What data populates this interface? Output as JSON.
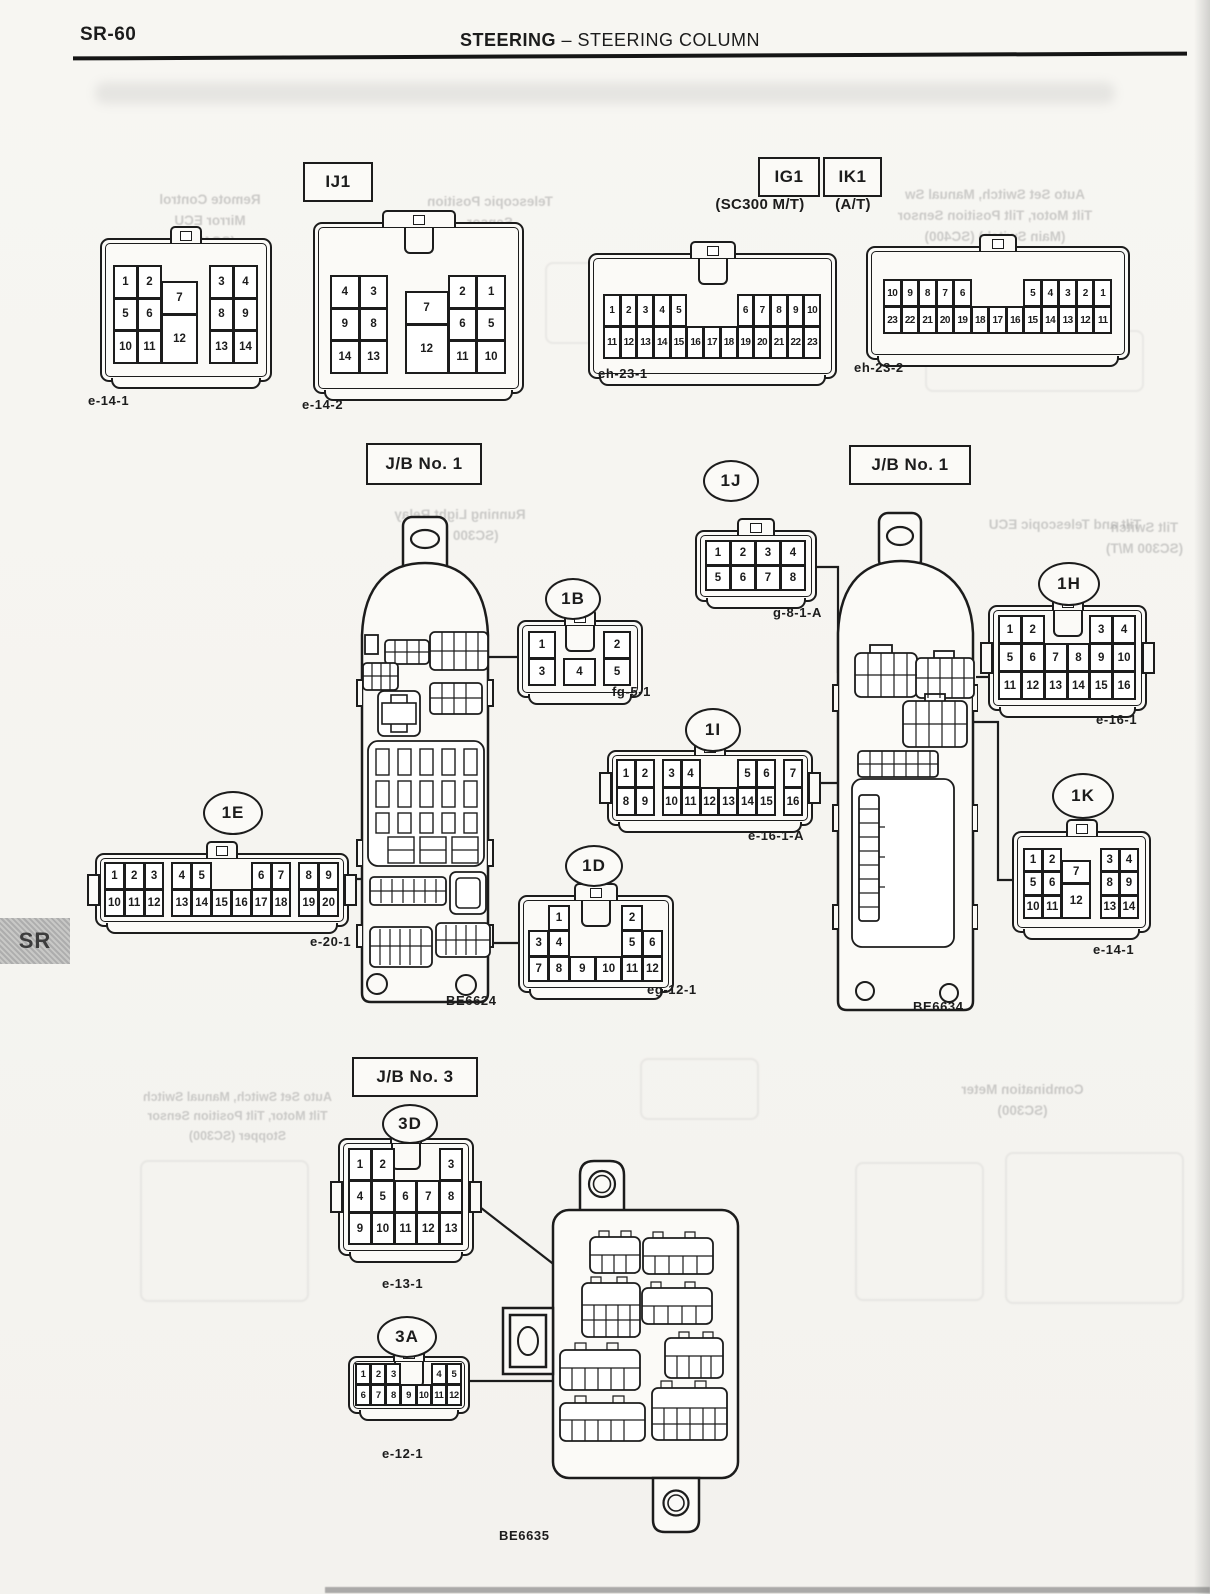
{
  "header": {
    "page_code": "SR-60",
    "section_main": "STEERING",
    "section_rest": " – STEERING COLUMN",
    "side_tab": "SR"
  },
  "boxes": {
    "ij1": "IJ1",
    "ig1": "IG1",
    "ik1": "IK1",
    "jb1_left": "J/B No. 1",
    "jb1_right": "J/B No. 1",
    "jb3": "J/B No. 3"
  },
  "subs": {
    "sc300mt": "(SC300 M/T)",
    "at": "(A/T)"
  },
  "bubbles": {
    "b1B": "1B",
    "b1J": "1J",
    "b1H": "1H",
    "b1I": "1I",
    "b1E": "1E",
    "b1D": "1D",
    "b1K": "1K",
    "b3D": "3D",
    "b3A": "3A"
  },
  "codes": {
    "e14_1": "e-14-1",
    "e14_2": "e-14-2",
    "eh23_1": "eh-23-1",
    "eh23_2": "eh-23-2",
    "fg5_1": "fg-5-1",
    "g8_1A": "g-8-1-A",
    "e16_1": "e-16-1",
    "e16_1A": "e-16-1-A",
    "e20_1": "e-20-1",
    "eg12_1": "eg-12-1",
    "e14_1k": "e-14-1",
    "e13_1": "e-13-1",
    "e12_1": "e-12-1",
    "be6624": "BE6624",
    "be6634": "BE6634",
    "be6635": "BE6635"
  },
  "connectors": {
    "e14_1": {
      "cols": "10,10,15,5,10,10",
      "rows": 6,
      "pad": "26px 12px 16px 12px",
      "cells": [
        [
          "1",
          1,
          1,
          1,
          2
        ],
        [
          "2",
          2,
          1,
          1,
          2
        ],
        [
          "5",
          1,
          3,
          1,
          2
        ],
        [
          "6",
          2,
          3,
          1,
          2
        ],
        [
          "10",
          1,
          5,
          1,
          2
        ],
        [
          "11",
          2,
          5,
          1,
          2
        ],
        [
          "7",
          3,
          2,
          1,
          2
        ],
        [
          "12",
          3,
          4,
          1,
          3
        ],
        [
          "3",
          5,
          1,
          1,
          2
        ],
        [
          "4",
          6,
          1,
          1,
          2
        ],
        [
          "8",
          5,
          3,
          1,
          2
        ],
        [
          "9",
          6,
          3,
          1,
          2
        ],
        [
          "13",
          5,
          5,
          1,
          2
        ],
        [
          "14",
          6,
          5,
          1,
          2
        ]
      ]
    },
    "e14_2": {
      "cols": "10,10,6,15,10,10",
      "rows": 6,
      "pad": "52px 16px 18px 16px",
      "lw": 70,
      "key": true,
      "cells": [
        [
          "4",
          1,
          1,
          1,
          2
        ],
        [
          "3",
          2,
          1,
          1,
          2
        ],
        [
          "9",
          1,
          3,
          1,
          2
        ],
        [
          "8",
          2,
          3,
          1,
          2
        ],
        [
          "14",
          1,
          5,
          1,
          2
        ],
        [
          "13",
          2,
          5,
          1,
          2
        ],
        [
          "7",
          4,
          2,
          1,
          2
        ],
        [
          "12",
          4,
          4,
          1,
          3
        ],
        [
          "2",
          5,
          1,
          1,
          2
        ],
        [
          "1",
          6,
          1,
          1,
          2
        ],
        [
          "6",
          5,
          3,
          1,
          2
        ],
        [
          "5",
          6,
          3,
          1,
          2
        ],
        [
          "11",
          5,
          5,
          1,
          2
        ],
        [
          "10",
          6,
          5,
          1,
          2
        ]
      ]
    },
    "eh23_1": {
      "cols": "1,1,1,1,1,1,1,1,1,1,1,1,1,1,1,1,1,1,1,1,1,1,1,1,1,1",
      "rows": 2,
      "pad": "40px 14px 18px 14px",
      "lw": 42,
      "key": true,
      "cells": [
        [
          "1",
          1,
          1,
          2
        ],
        [
          "2",
          3,
          1,
          2
        ],
        [
          "3",
          5,
          1,
          2
        ],
        [
          "4",
          7,
          1,
          2
        ],
        [
          "5",
          9,
          1,
          2
        ],
        [
          "6",
          17,
          1,
          2
        ],
        [
          "7",
          19,
          1,
          2
        ],
        [
          "8",
          21,
          1,
          2
        ],
        [
          "9",
          23,
          1,
          2
        ],
        [
          "10",
          25,
          1,
          2
        ],
        [
          "11",
          1,
          2,
          2
        ],
        [
          "12",
          3,
          2,
          2
        ],
        [
          "13",
          5,
          2,
          2
        ],
        [
          "14",
          7,
          2,
          2
        ],
        [
          "15",
          9,
          2,
          2
        ],
        [
          "16",
          11,
          2,
          2
        ],
        [
          "17",
          13,
          2,
          2
        ],
        [
          "18",
          15,
          2,
          2
        ],
        [
          "19",
          17,
          2,
          2
        ],
        [
          "20",
          19,
          2,
          2
        ],
        [
          "21",
          21,
          2,
          2
        ],
        [
          "22",
          23,
          2,
          2
        ],
        [
          "23",
          25,
          2,
          2
        ]
      ]
    },
    "eh23_2": {
      "cols": "1,1,1,1,1,1,1,1,1,1,1,1,1,1,1,1,1,1,1,1,1,1,1,1,1,1",
      "rows": 2,
      "pad": "32px 16px 24px 16px",
      "lw": 34,
      "cells": [
        [
          "10",
          1,
          1,
          2
        ],
        [
          "9",
          3,
          1,
          2
        ],
        [
          "8",
          5,
          1,
          2
        ],
        [
          "7",
          7,
          1,
          2
        ],
        [
          "6",
          9,
          1,
          2
        ],
        [
          "5",
          17,
          1,
          2
        ],
        [
          "4",
          19,
          1,
          2
        ],
        [
          "3",
          21,
          1,
          2
        ],
        [
          "2",
          23,
          1,
          2
        ],
        [
          "1",
          25,
          1,
          2
        ],
        [
          "23",
          1,
          2,
          2
        ],
        [
          "22",
          3,
          2,
          2
        ],
        [
          "21",
          5,
          2,
          2
        ],
        [
          "20",
          7,
          2,
          2
        ],
        [
          "19",
          9,
          2,
          2
        ],
        [
          "18",
          11,
          2,
          2
        ],
        [
          "17",
          13,
          2,
          2
        ],
        [
          "16",
          15,
          2,
          2
        ],
        [
          "15",
          17,
          2,
          2
        ],
        [
          "14",
          19,
          2,
          2
        ],
        [
          "13",
          21,
          2,
          2
        ],
        [
          "12",
          23,
          2,
          2
        ],
        [
          "11",
          25,
          2,
          2
        ]
      ]
    },
    "fg5_1": {
      "cols": "10,3,12,3,10",
      "rows": 2,
      "pad": "10px",
      "key": true,
      "cells": [
        [
          "1",
          1,
          1
        ],
        [
          "2",
          5,
          1
        ],
        [
          "3",
          1,
          2
        ],
        [
          "4",
          3,
          2
        ],
        [
          "5",
          5,
          2
        ]
      ]
    },
    "g8_1A": {
      "cols": "1,1,1,1",
      "rows": 2,
      "pad": "9px",
      "lw": 34,
      "cells": [
        [
          "1",
          1,
          1
        ],
        [
          "2",
          2,
          1
        ],
        [
          "3",
          3,
          1
        ],
        [
          "4",
          4,
          1
        ],
        [
          "5",
          1,
          2
        ],
        [
          "6",
          2,
          2
        ],
        [
          "7",
          3,
          2
        ],
        [
          "8",
          4,
          2
        ]
      ]
    },
    "e16_1": {
      "cols": "1,1,1,1,1,1",
      "rows": 3,
      "pad": "9px",
      "ears": true,
      "key": true,
      "cells": [
        [
          "1",
          1,
          1
        ],
        [
          "2",
          2,
          1
        ],
        [
          "3",
          5,
          1
        ],
        [
          "4",
          6,
          1
        ],
        [
          "5",
          1,
          2
        ],
        [
          "6",
          2,
          2
        ],
        [
          "7",
          3,
          2
        ],
        [
          "8",
          4,
          2
        ],
        [
          "9",
          5,
          2
        ],
        [
          "10",
          6,
          2
        ],
        [
          "11",
          1,
          3
        ],
        [
          "12",
          2,
          3
        ],
        [
          "13",
          3,
          3
        ],
        [
          "14",
          4,
          3
        ],
        [
          "15",
          5,
          3
        ],
        [
          "16",
          6,
          3
        ]
      ]
    },
    "e16_1A": {
      "cols": "10,10,4,10,10,10,10,10,10,4,10",
      "rows": 2,
      "pad": "8px",
      "ears": true,
      "cells": [
        [
          "1",
          1,
          1
        ],
        [
          "2",
          2,
          1
        ],
        [
          "3",
          4,
          1
        ],
        [
          "4",
          5,
          1
        ],
        [
          "5",
          8,
          1
        ],
        [
          "6",
          9,
          1
        ],
        [
          "7",
          11,
          1
        ],
        [
          "8",
          1,
          2
        ],
        [
          "9",
          2,
          2
        ],
        [
          "10",
          4,
          2
        ],
        [
          "11",
          5,
          2
        ],
        [
          "12",
          6,
          2
        ],
        [
          "13",
          7,
          2
        ],
        [
          "14",
          8,
          2
        ],
        [
          "15",
          9,
          2
        ],
        [
          "16",
          11,
          2
        ]
      ]
    },
    "e20_1": {
      "cols": "10,10,10,4,10,10,10,10,10,10,4,10,10",
      "rows": 2,
      "pad": "8px",
      "ears": true,
      "cells": [
        [
          "1",
          1,
          1
        ],
        [
          "2",
          2,
          1
        ],
        [
          "3",
          3,
          1
        ],
        [
          "4",
          5,
          1
        ],
        [
          "5",
          6,
          1
        ],
        [
          "6",
          9,
          1
        ],
        [
          "7",
          10,
          1
        ],
        [
          "8",
          12,
          1
        ],
        [
          "9",
          13,
          1
        ],
        [
          "10",
          1,
          2
        ],
        [
          "11",
          2,
          2
        ],
        [
          "12",
          3,
          2
        ],
        [
          "13",
          5,
          2
        ],
        [
          "14",
          6,
          2
        ],
        [
          "15",
          7,
          2
        ],
        [
          "16",
          8,
          2
        ],
        [
          "17",
          9,
          2
        ],
        [
          "18",
          10,
          2
        ],
        [
          "19",
          12,
          2
        ],
        [
          "20",
          13,
          2
        ]
      ]
    },
    "eg12_1": {
      "cols": "10,10,13,13,10,10",
      "rows": 3,
      "pad": "9px",
      "lw": 40,
      "key": true,
      "cells": [
        [
          "1",
          2,
          1
        ],
        [
          "2",
          5,
          1
        ],
        [
          "3",
          1,
          2
        ],
        [
          "4",
          2,
          2
        ],
        [
          "5",
          5,
          2
        ],
        [
          "6",
          6,
          2
        ],
        [
          "7",
          1,
          3
        ],
        [
          "8",
          2,
          3
        ],
        [
          "9",
          3,
          3
        ],
        [
          "10",
          4,
          3
        ],
        [
          "11",
          5,
          3
        ],
        [
          "12",
          6,
          3
        ]
      ]
    },
    "e14_1k": {
      "cols": "10,10,15,5,10,10",
      "rows": 6,
      "pad": "16px 10px 12px 10px",
      "cells": [
        [
          "1",
          1,
          1,
          1,
          2
        ],
        [
          "2",
          2,
          1,
          1,
          2
        ],
        [
          "5",
          1,
          3,
          1,
          2
        ],
        [
          "6",
          2,
          3,
          1,
          2
        ],
        [
          "10",
          1,
          5,
          1,
          2
        ],
        [
          "11",
          2,
          5,
          1,
          2
        ],
        [
          "7",
          3,
          2,
          1,
          2
        ],
        [
          "12",
          3,
          4,
          1,
          3
        ],
        [
          "3",
          5,
          1,
          1,
          2
        ],
        [
          "4",
          6,
          1,
          1,
          2
        ],
        [
          "8",
          5,
          3,
          1,
          2
        ],
        [
          "9",
          6,
          3,
          1,
          2
        ],
        [
          "13",
          5,
          5,
          1,
          2
        ],
        [
          "14",
          6,
          5,
          1,
          2
        ]
      ]
    },
    "e13_1": {
      "cols": "1,1,1,1,1",
      "rows": 3,
      "pad": "9px",
      "ears": true,
      "key": true,
      "cells": [
        [
          "1",
          1,
          1
        ],
        [
          "2",
          2,
          1
        ],
        [
          "3",
          5,
          1
        ],
        [
          "4",
          1,
          2
        ],
        [
          "5",
          2,
          2
        ],
        [
          "6",
          3,
          2
        ],
        [
          "7",
          4,
          2
        ],
        [
          "8",
          5,
          2
        ],
        [
          "9",
          1,
          3
        ],
        [
          "10",
          2,
          3
        ],
        [
          "11",
          3,
          3
        ],
        [
          "12",
          4,
          3
        ],
        [
          "13",
          5,
          3
        ]
      ]
    },
    "e12_1": {
      "cols": "1,1,1,1,1,1,1",
      "rows": 2,
      "pad": "6px",
      "key": true,
      "cells": [
        [
          "1",
          1,
          1
        ],
        [
          "2",
          2,
          1
        ],
        [
          "3",
          3,
          1
        ],
        [
          "4",
          6,
          1
        ],
        [
          "5",
          7,
          1
        ],
        [
          "6",
          1,
          2
        ],
        [
          "7",
          2,
          2
        ],
        [
          "8",
          3,
          2
        ],
        [
          "9",
          4,
          2
        ],
        [
          "10",
          5,
          2
        ],
        [
          "11",
          6,
          2
        ],
        [
          "12",
          7,
          2
        ]
      ]
    }
  },
  "ghosts": [
    {
      "lines": [
        "Remote Control",
        "Mirror ECU",
        "(SC400)"
      ]
    },
    {
      "lines": [
        "Telescopic Position",
        "Sensor"
      ]
    },
    {
      "lines": [
        "Auto Set Switch, Manual Sw",
        "Tilt Motor, Tilt Position Sensor",
        "(Main Switch) (SC400)"
      ]
    },
    {
      "lines": [
        "Running Light Relay",
        "(SC300 M/T)"
      ]
    },
    {
      "lines": [
        "Tilt and Telescopic ECU"
      ]
    },
    {
      "lines": [
        "Tilt Switch",
        "(SC300 M/T)"
      ]
    },
    {
      "lines": [
        "Combination Meter",
        "(SC300)"
      ]
    },
    {
      "lines": [
        "Auto Set Switch, Manual Switch",
        "Tilt Motor, Tilt Position Sensor",
        "Stopper (SC300)"
      ]
    }
  ]
}
